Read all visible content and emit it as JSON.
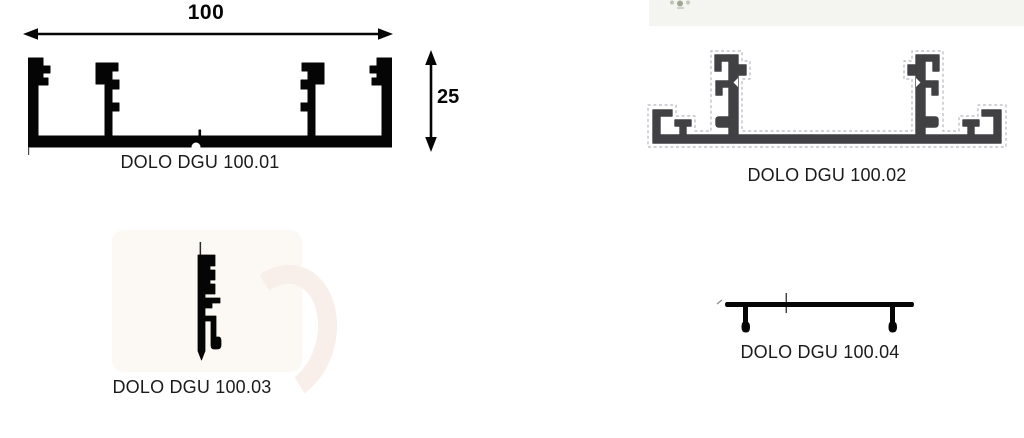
{
  "figures": [
    {
      "id": "100.01",
      "label": "DOLO DGU 100.01",
      "width_dim": "100",
      "height_dim": "25"
    },
    {
      "id": "100.02",
      "label": "DOLO DGU 100.02"
    },
    {
      "id": "100.03",
      "label": "DOLO DGU 100.03"
    },
    {
      "id": "100.04",
      "label": "DOLO DGU 100.04"
    }
  ],
  "colors": {
    "ink": "#050505",
    "label_text": "#1b1b1b",
    "profile2_fill": "#414144",
    "dashed_outline": "#b4b7bf",
    "photo_strip_bg": "#f4f4f1"
  }
}
